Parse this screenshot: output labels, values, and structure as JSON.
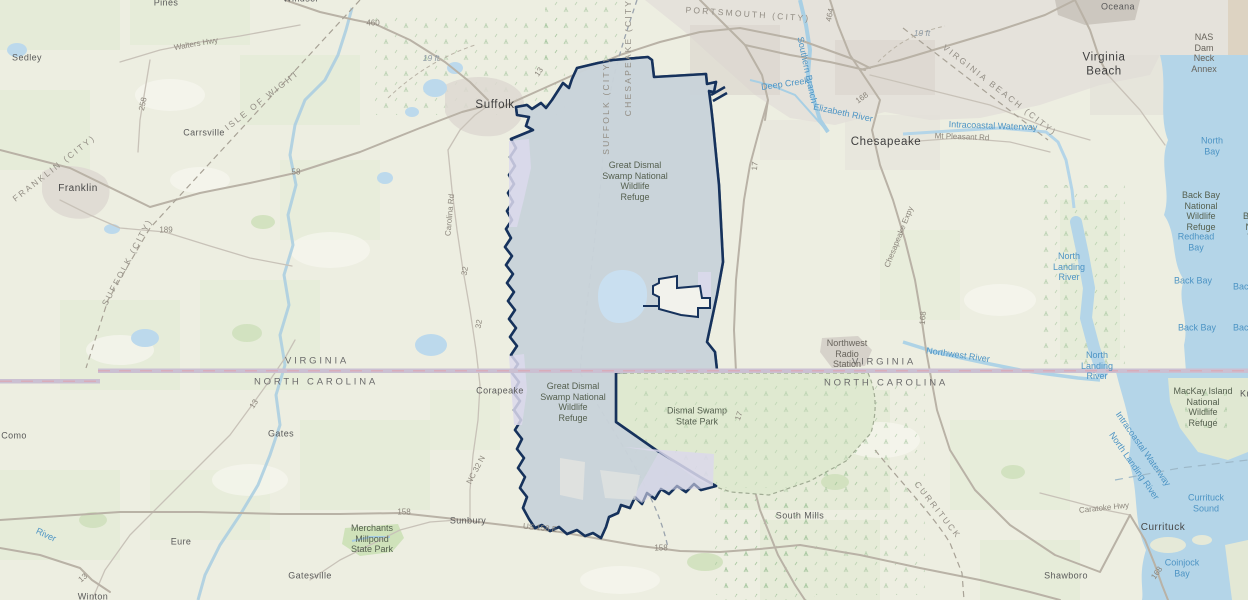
{
  "map": {
    "description": "Topographic basemap of southeastern Virginia and northeastern North Carolina showing the Great Dismal Swamp National Wildlife Refuge boundary",
    "colors": {
      "refuge_fill": "#c9d2d9",
      "refuge_border": "#16325c",
      "state_park_fill": "#dfe9d0",
      "inholding_lavender": "#dcd9ec",
      "water": "#b4d5e8",
      "state_line_band": "#cbc0d2",
      "land": "#edeee1",
      "urban": "#ddd8d1"
    },
    "labels": [
      {
        "n": "suffolk",
        "t": "Suffolk",
        "x": 495,
        "y": 106,
        "c": "city"
      },
      {
        "n": "chesapeake",
        "t": "Chesapeake",
        "x": 886,
        "y": 143,
        "c": "city"
      },
      {
        "n": "virginia-beach",
        "t": "Virginia\nBeach",
        "x": 1104,
        "y": 65,
        "c": "city"
      },
      {
        "n": "franklin",
        "t": "Franklin",
        "x": 78,
        "y": 189,
        "c": "town2"
      },
      {
        "n": "currituck-town",
        "t": "Currituck",
        "x": 1163,
        "y": 528,
        "c": "town2"
      },
      {
        "n": "sedley",
        "t": "Sedley",
        "x": 27,
        "y": 58,
        "c": "town"
      },
      {
        "n": "carrsville",
        "t": "Carrsville",
        "x": 204,
        "y": 133,
        "c": "town"
      },
      {
        "n": "corapeake",
        "t": "Corapeake",
        "x": 500,
        "y": 391,
        "c": "town"
      },
      {
        "n": "gates",
        "t": "Gates",
        "x": 281,
        "y": 434,
        "c": "town"
      },
      {
        "n": "como",
        "t": "Como",
        "x": 14,
        "y": 436,
        "c": "town"
      },
      {
        "n": "eure",
        "t": "Eure",
        "x": 181,
        "y": 542,
        "c": "town"
      },
      {
        "n": "gatesville",
        "t": "Gatesville",
        "x": 310,
        "y": 576,
        "c": "town"
      },
      {
        "n": "sunbury",
        "t": "Sunbury",
        "x": 468,
        "y": 521,
        "c": "town"
      },
      {
        "n": "south-mills",
        "t": "South Mills",
        "x": 800,
        "y": 516,
        "c": "town"
      },
      {
        "n": "shawboro",
        "t": "Shawboro",
        "x": 1066,
        "y": 576,
        "c": "town"
      },
      {
        "n": "winton",
        "t": "Winton",
        "x": 93,
        "y": 597,
        "c": "town"
      },
      {
        "n": "oceana",
        "t": "Oceana",
        "x": 1118,
        "y": 7,
        "c": "town"
      },
      {
        "n": "pines",
        "t": "Pines",
        "x": 166,
        "y": 3,
        "c": "town"
      },
      {
        "n": "windsor",
        "t": "Windsor",
        "x": 301,
        "y": -1,
        "c": "town"
      },
      {
        "n": "isle-of-wight",
        "t": "ISLE OF WIGHT",
        "x": 262,
        "y": 100,
        "c": "county",
        "r": -38
      },
      {
        "n": "franklin-city",
        "t": "FRANKLIN (CITY)",
        "x": 54,
        "y": 168,
        "c": "county",
        "r": -38
      },
      {
        "n": "suffolk-city-w",
        "t": "SUFFOLK (CITY)",
        "x": 127,
        "y": 262,
        "c": "county",
        "r": -62
      },
      {
        "n": "portsmouth-city",
        "t": "PORTSMOUTH (CITY)",
        "x": 748,
        "y": 14,
        "c": "county",
        "r": 4
      },
      {
        "n": "suffolk-city-canal",
        "t": "SUFFOLK (CITY)",
        "x": 606,
        "y": 106,
        "c": "county",
        "r": -90
      },
      {
        "n": "chesapeake-city-canal",
        "t": "CHESAPEAKE (CITY)",
        "x": 628,
        "y": 55,
        "c": "county",
        "r": -90
      },
      {
        "n": "virginia-beach-city",
        "t": "VIRGINIA BEACH (CITY)",
        "x": 1000,
        "y": 90,
        "c": "county",
        "r": 38
      },
      {
        "n": "currituck-county",
        "t": "CURRITUCK",
        "x": 938,
        "y": 510,
        "c": "county",
        "r": 52
      },
      {
        "n": "virginia-left",
        "t": "VIRGINIA",
        "x": 317,
        "y": 361,
        "c": "state"
      },
      {
        "n": "north-carolina-left",
        "t": "NORTH CAROLINA",
        "x": 316,
        "y": 382,
        "c": "state"
      },
      {
        "n": "virginia-right",
        "t": "VIRGINIA",
        "x": 884,
        "y": 362,
        "c": "state"
      },
      {
        "n": "north-carolina-right",
        "t": "NORTH CAROLINA",
        "x": 886,
        "y": 383,
        "c": "state"
      },
      {
        "n": "gds-refuge-north",
        "t": "Great Dismal\nSwamp National\nWildlife\nRefuge",
        "x": 635,
        "y": 181,
        "c": "refuge"
      },
      {
        "n": "gds-refuge-south",
        "t": "Great Dismal\nSwamp National\nWildlife\nRefuge",
        "x": 573,
        "y": 402,
        "c": "refuge"
      },
      {
        "n": "dismal-swamp-state-park",
        "t": "Dismal Swamp\nState Park",
        "x": 697,
        "y": 416,
        "c": "refuge"
      },
      {
        "n": "merchants-millpond",
        "t": "Merchants\nMillpond\nState Park",
        "x": 372,
        "y": 539,
        "c": "refuge"
      },
      {
        "n": "back-bay-nwr",
        "t": "Back Bay\nNational\nWildlife\nRefuge",
        "x": 1201,
        "y": 211,
        "c": "refuge"
      },
      {
        "n": "back-bay-nwr-clipped",
        "t": "Back Bay\nNational\nWildlife\nRefuge",
        "x": 1262,
        "y": 232,
        "c": "refuge"
      },
      {
        "n": "mackay-island-nwr",
        "t": "MacKay Island\nNational\nWildlife\nRefuge",
        "x": 1203,
        "y": 407,
        "c": "refuge"
      },
      {
        "n": "knotts-island-clipped",
        "t": "Knotts",
        "x": 1254,
        "y": 394,
        "c": "town"
      },
      {
        "n": "nas-dam-neck",
        "t": "NAS\nDam\nNeck\nAnnex",
        "x": 1204,
        "y": 53,
        "c": "facility"
      },
      {
        "n": "northwest-radio-station",
        "t": "Northwest\nRadio\nStation",
        "x": 847,
        "y": 354,
        "c": "facility"
      },
      {
        "n": "deep-creek",
        "t": "Deep Creek",
        "x": 785,
        "y": 84,
        "c": "water",
        "r": -8
      },
      {
        "n": "southern-branch",
        "t": "Southern Branch",
        "x": 807,
        "y": 70,
        "c": "water",
        "r": 78
      },
      {
        "n": "elizabeth-river",
        "t": "Elizabeth River",
        "x": 843,
        "y": 113,
        "c": "water",
        "r": 12
      },
      {
        "n": "intracoastal-waterway-n",
        "t": "Intracoastal Waterway",
        "x": 993,
        "y": 126,
        "c": "water",
        "r": 2
      },
      {
        "n": "north-bay",
        "t": "North\nBay",
        "x": 1212,
        "y": 146,
        "c": "water"
      },
      {
        "n": "redhead-bay",
        "t": "Redhead\nBay",
        "x": 1196,
        "y": 242,
        "c": "water"
      },
      {
        "n": "back-bay-1",
        "t": "Back Bay",
        "x": 1193,
        "y": 281,
        "c": "water"
      },
      {
        "n": "back-bay-2",
        "t": "Back Bay",
        "x": 1197,
        "y": 328,
        "c": "water"
      },
      {
        "n": "back-bay-clip-1",
        "t": "Back Bay",
        "x": 1252,
        "y": 287,
        "c": "water"
      },
      {
        "n": "back-bay-clip-2",
        "t": "Back Bay",
        "x": 1252,
        "y": 328,
        "c": "water"
      },
      {
        "n": "north-landing-river-1",
        "t": "North\nLanding\nRiver",
        "x": 1069,
        "y": 267,
        "c": "water"
      },
      {
        "n": "north-landing-river-2",
        "t": "North\nLanding\nRiver",
        "x": 1097,
        "y": 366,
        "c": "water"
      },
      {
        "n": "intracoastal-waterway-s",
        "t": "Intracoastal Waterway",
        "x": 1143,
        "y": 449,
        "c": "water",
        "r": 55
      },
      {
        "n": "north-landing-river-3",
        "t": "North Landing River",
        "x": 1134,
        "y": 466,
        "c": "water",
        "r": 55
      },
      {
        "n": "currituck-sound",
        "t": "Currituck\nSound",
        "x": 1206,
        "y": 503,
        "c": "water"
      },
      {
        "n": "coinjock-bay",
        "t": "Coinjock\nBay",
        "x": 1182,
        "y": 568,
        "c": "water"
      },
      {
        "n": "northwest-river",
        "t": "Northwest River",
        "x": 958,
        "y": 355,
        "c": "water",
        "r": 8
      },
      {
        "n": "river-clipped",
        "t": "River",
        "x": 46,
        "y": 535,
        "c": "water",
        "r": 25
      },
      {
        "n": "contour-19ft-a",
        "t": "19 ft",
        "x": 431,
        "y": 58,
        "c": "contour"
      },
      {
        "n": "contour-19ft-b",
        "t": "19 ft",
        "x": 922,
        "y": 33,
        "c": "contour"
      },
      {
        "n": "route-460",
        "t": "460",
        "x": 373,
        "y": 23,
        "c": "road"
      },
      {
        "n": "route-258",
        "t": "258",
        "x": 143,
        "y": 104,
        "c": "road",
        "r": -78
      },
      {
        "n": "route-58",
        "t": "58",
        "x": 296,
        "y": 172,
        "c": "road"
      },
      {
        "n": "route-189",
        "t": "189",
        "x": 166,
        "y": 230,
        "c": "road"
      },
      {
        "n": "route-13-a",
        "t": "13",
        "x": 539,
        "y": 72,
        "c": "road",
        "r": -55
      },
      {
        "n": "route-13-b",
        "t": "13",
        "x": 254,
        "y": 404,
        "c": "road",
        "r": -55
      },
      {
        "n": "route-13-c",
        "t": "13",
        "x": 83,
        "y": 578,
        "c": "road",
        "r": -40
      },
      {
        "n": "route-32-a",
        "t": "32",
        "x": 465,
        "y": 271,
        "c": "road",
        "r": -80
      },
      {
        "n": "route-32-b",
        "t": "32",
        "x": 479,
        "y": 324,
        "c": "road",
        "r": -80
      },
      {
        "n": "route-17-a",
        "t": "17",
        "x": 755,
        "y": 166,
        "c": "road",
        "r": -85
      },
      {
        "n": "route-17-b",
        "t": "17",
        "x": 739,
        "y": 416,
        "c": "road",
        "r": -70
      },
      {
        "n": "route-168-a",
        "t": "168",
        "x": 862,
        "y": 98,
        "c": "road",
        "r": -35
      },
      {
        "n": "route-168-b",
        "t": "168",
        "x": 923,
        "y": 318,
        "c": "road",
        "r": -85
      },
      {
        "n": "route-168-c",
        "t": "168",
        "x": 1157,
        "y": 573,
        "c": "road",
        "r": -55
      },
      {
        "n": "route-158-a",
        "t": "158",
        "x": 404,
        "y": 512,
        "c": "road"
      },
      {
        "n": "route-158-b",
        "t": "158",
        "x": 661,
        "y": 548,
        "c": "road"
      },
      {
        "n": "route-464",
        "t": "464",
        "x": 830,
        "y": 15,
        "c": "road",
        "r": -78
      },
      {
        "n": "walters-hwy",
        "t": "Walters Hwy",
        "x": 196,
        "y": 44,
        "c": "road",
        "r": -10
      },
      {
        "n": "carolina-rd",
        "t": "Carolina Rd",
        "x": 450,
        "y": 215,
        "c": "road",
        "r": -85
      },
      {
        "n": "nc-32-n",
        "t": "NC 32 N",
        "x": 476,
        "y": 470,
        "c": "road",
        "r": -62
      },
      {
        "n": "mt-pleasant-rd",
        "t": "Mt Pleasant Rd",
        "x": 962,
        "y": 137,
        "c": "road",
        "r": 2
      },
      {
        "n": "caratoke-hwy",
        "t": "Caratoke Hwy",
        "x": 1104,
        "y": 508,
        "c": "road",
        "r": -6
      },
      {
        "n": "us-158-e",
        "t": "US 158 E",
        "x": 540,
        "y": 528,
        "c": "road",
        "r": 6
      },
      {
        "n": "chesapeake-expy",
        "t": "Chesapeake Expy",
        "x": 899,
        "y": 237,
        "c": "road",
        "r": -68
      }
    ]
  }
}
